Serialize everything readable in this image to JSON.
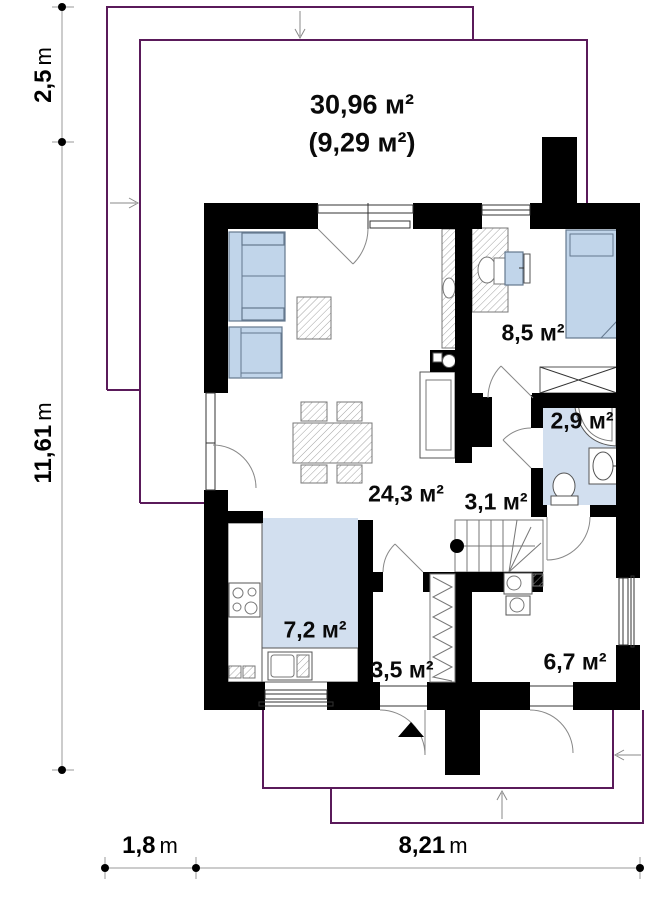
{
  "plan_title": "first floor plan",
  "roof_area": {
    "primary": "30,96 м²",
    "secondary": "(9,29 м²)"
  },
  "rooms": [
    {
      "name": "living-dining",
      "area": "24,3 м²"
    },
    {
      "name": "bedroom",
      "area": "8,5 м²"
    },
    {
      "name": "bathroom",
      "area": "2,9 м²"
    },
    {
      "name": "hallway-stairs",
      "area": "3,1 м²"
    },
    {
      "name": "kitchen",
      "area": "7,2 м²"
    },
    {
      "name": "vestibule",
      "area": "3,5 м²"
    },
    {
      "name": "hall",
      "area": "6,7 м²"
    }
  ],
  "dimensions": {
    "left_upper": {
      "value": "2,5",
      "unit": "m"
    },
    "left_total": {
      "value": "11,61",
      "unit": "m"
    },
    "bottom_left": {
      "value": "1,8",
      "unit": "m"
    },
    "bottom_total": {
      "value": "8,21",
      "unit": "m"
    }
  },
  "colors": {
    "wall": "#000000",
    "floor": "#d2dfef",
    "furn": "#c1d5ea",
    "roof": "#5a1a5a"
  }
}
